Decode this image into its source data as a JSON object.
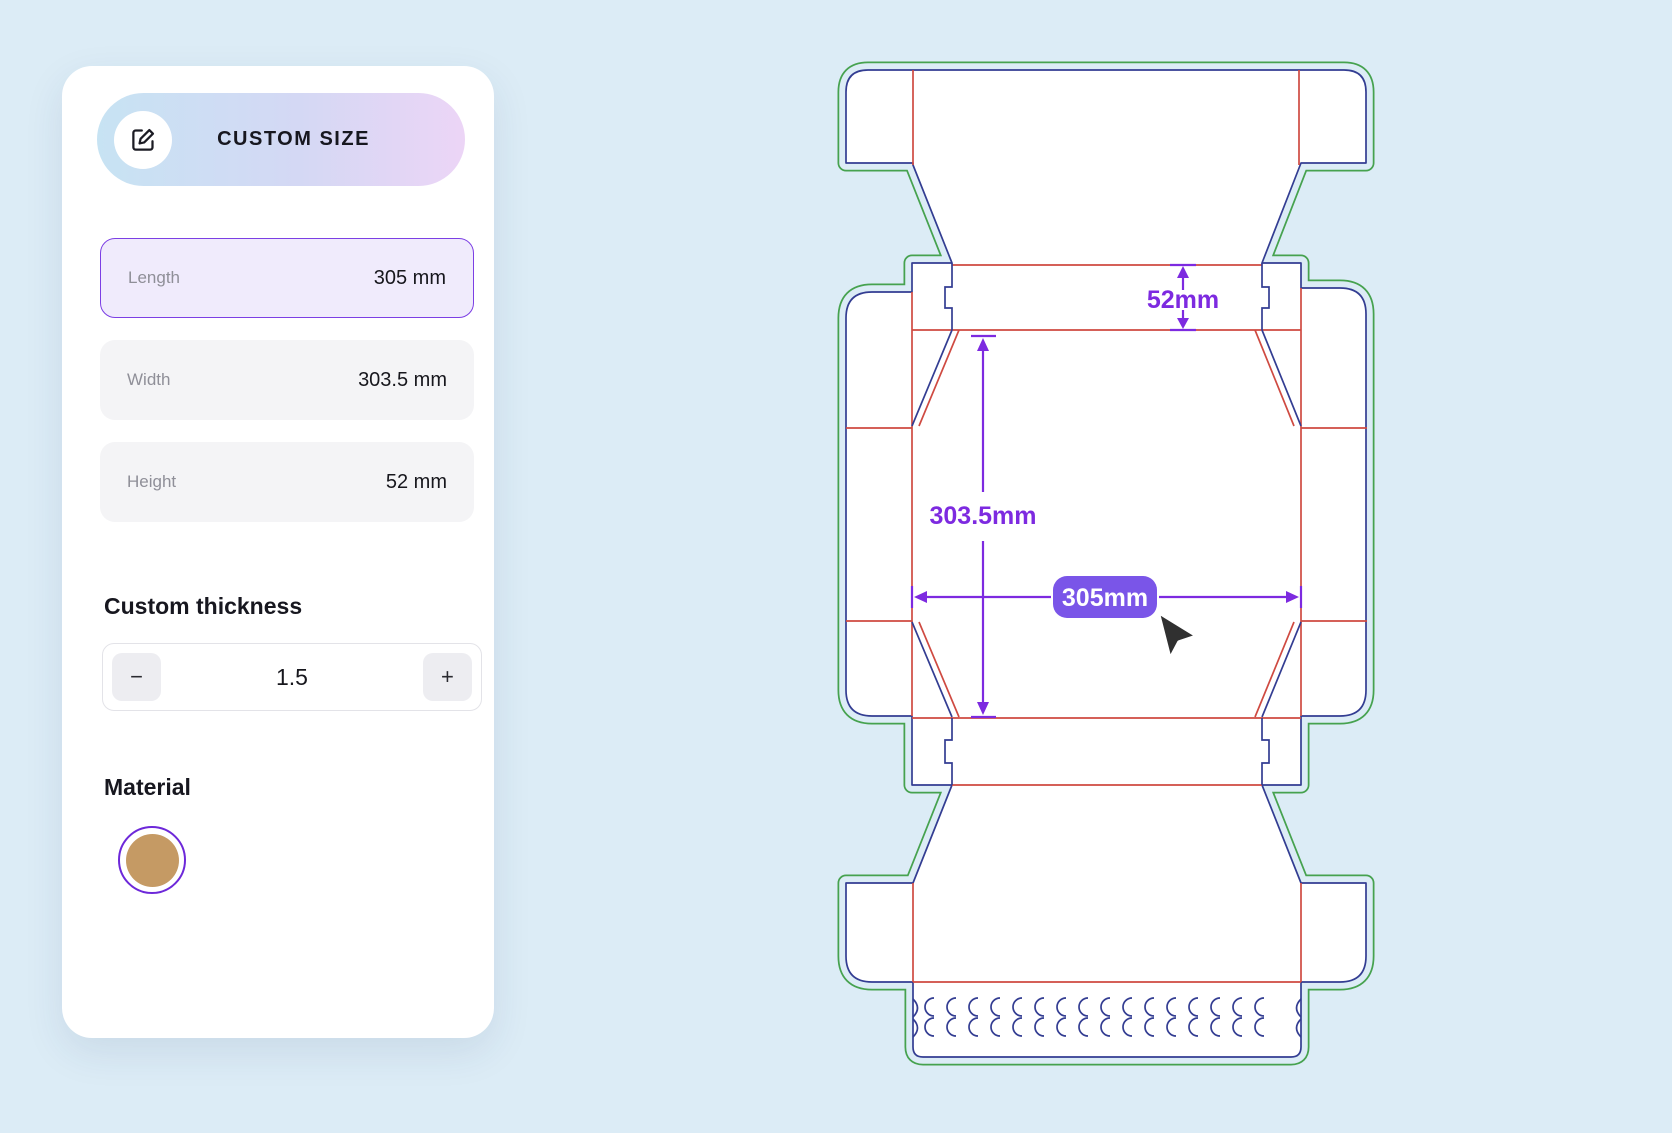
{
  "page": {
    "background": "#dcecf6"
  },
  "panel": {
    "header": {
      "label": "CUSTOM SIZE"
    },
    "fields": [
      {
        "label": "Length",
        "value": "305 mm",
        "active": true
      },
      {
        "label": "Width",
        "value": "303.5 mm",
        "active": false
      },
      {
        "label": "Height",
        "value": "52 mm",
        "active": false
      }
    ],
    "thickness": {
      "heading": "Custom thickness",
      "minus_label": "−",
      "value": "1.5",
      "plus_label": "+"
    },
    "material": {
      "heading": "Material",
      "swatch_color": "#c59a64",
      "ring_color": "#6d28d9"
    }
  },
  "dieline": {
    "height_label": "52mm",
    "width_label": "303.5mm",
    "length_label": "305mm",
    "colors": {
      "cut": "#333d92",
      "crease": "#cf4a41",
      "bleed": "#46a24f",
      "dimension": "#7d2ae0",
      "badge": "#7a55e8",
      "panel_fill": "#ffffff"
    }
  }
}
